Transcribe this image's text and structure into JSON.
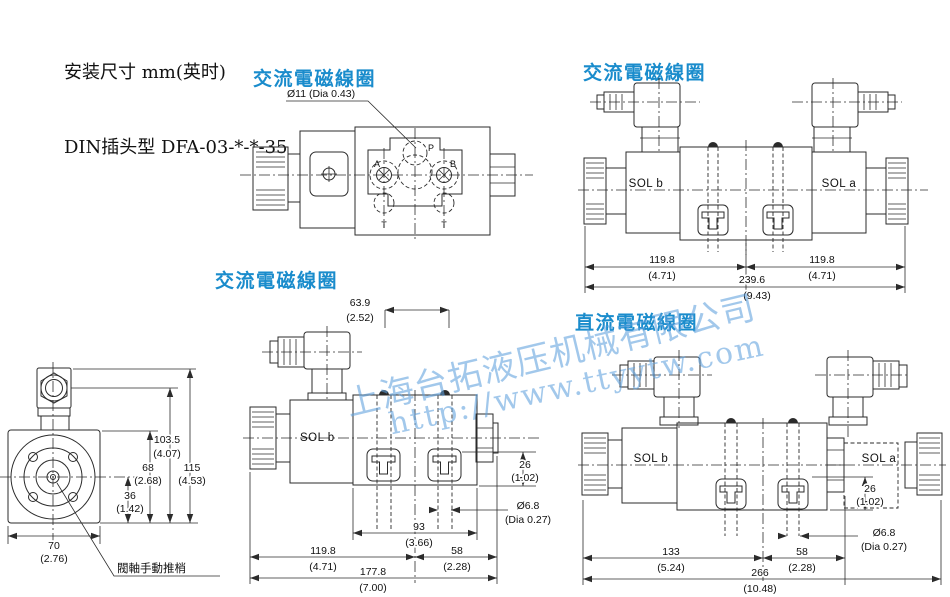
{
  "header": {
    "line1": "安装尺寸 mm(英时)",
    "line2": "DIN插头型 DFA-03-*-*-35"
  },
  "titles": {
    "top_mid": "交流電磁線圈",
    "top_right": "交流電磁線圈",
    "mid_left": "交流電磁線圈",
    "bottom_right": "直流電磁線圈"
  },
  "watermark": {
    "company": "上海台拓液压机械有限公司",
    "url": "http://www.ttyytw.com"
  },
  "colors": {
    "title_blue": "#1a8ccc",
    "watermark_blue": "#66a8dc",
    "line": "#2b2b2b"
  },
  "top_mid_view": {
    "dia_label": "Ø11 (Dia 0.43)",
    "ports": {
      "a": "A",
      "b": "B",
      "p": "P",
      "t_left": "T",
      "t_right": "T"
    }
  },
  "top_right_view": {
    "sol_b": "SOL b",
    "sol_a": "SOL a",
    "dims": {
      "left_mm": "119.8",
      "left_in": "(4.71)",
      "right_mm": "119.8",
      "right_in": "(4.71)",
      "total_mm": "239.6",
      "total_in": "(9.43)"
    }
  },
  "bottom_left_view": {
    "pin_label": "閥軸手動推梢",
    "dims": {
      "h1_mm": "103.5",
      "h1_in": "(4.07)",
      "h2_mm": "68",
      "h2_in": "(2.68)",
      "h3_mm": "36",
      "h3_in": "(1.42)",
      "h4_mm": "115",
      "h4_in": "(4.53)",
      "w_mm": "70",
      "w_in": "(2.76)"
    }
  },
  "bottom_mid_view": {
    "sol_b": "SOL b",
    "dims": {
      "top_mm": "63.9",
      "top_in": "(2.52)",
      "side_mm": "26",
      "side_in": "(1.02)",
      "hole_mm": "Ø6.8",
      "hole_in": "(Dia 0.27)",
      "body_mm": "93",
      "body_in": "(3.66)",
      "left_mm": "119.8",
      "left_in": "(4.71)",
      "right_mm": "58",
      "right_in": "(2.28)",
      "total_mm": "177.8",
      "total_in": "(7.00)"
    }
  },
  "bottom_right_view": {
    "sol_b": "SOL b",
    "sol_a": "SOL a",
    "dims": {
      "side_mm": "26",
      "side_in": "(1.02)",
      "hole_mm": "Ø6.8",
      "hole_in": "(Dia 0.27)",
      "left_mm": "133",
      "left_in": "(5.24)",
      "right_mm": "58",
      "right_in": "(2.28)",
      "total_mm": "266",
      "total_in": "(10.48)"
    }
  }
}
